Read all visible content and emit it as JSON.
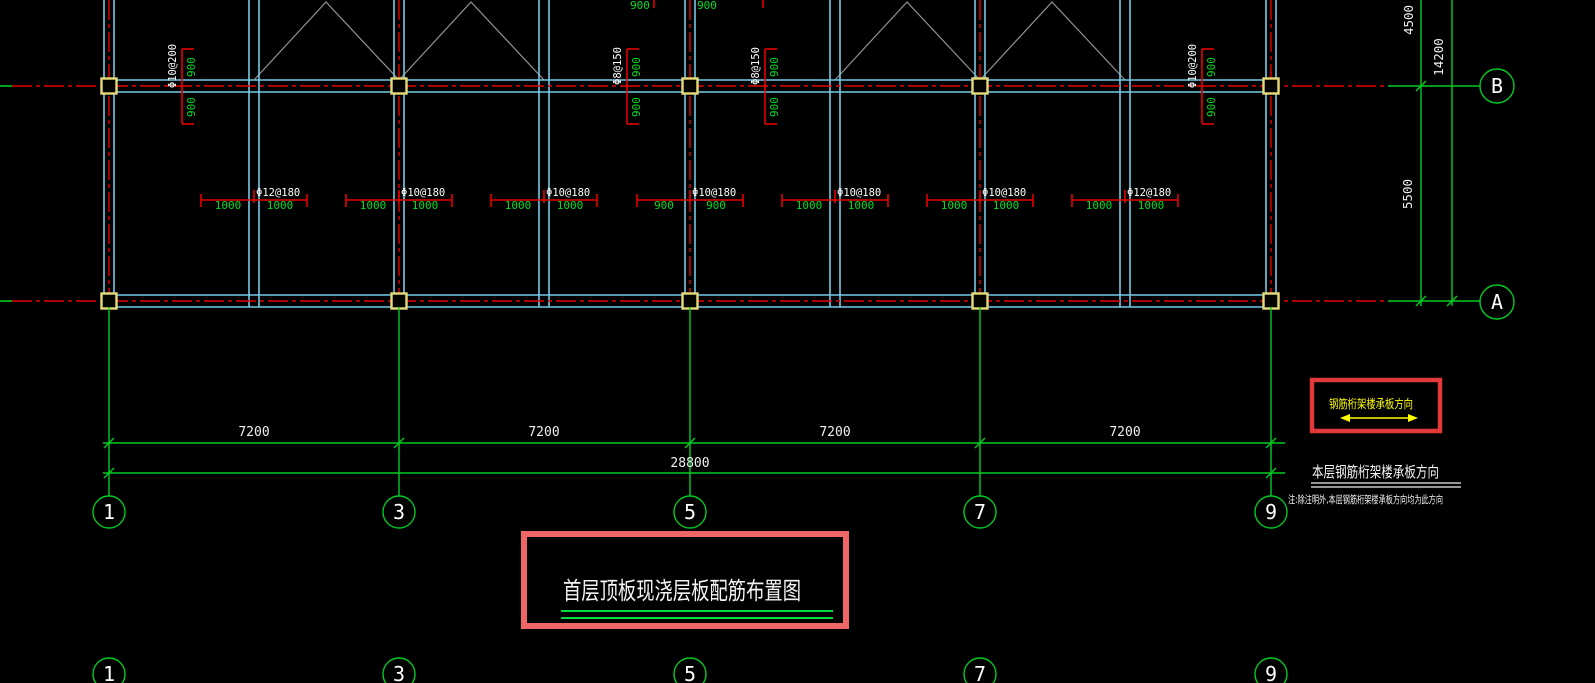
{
  "title_block": {
    "title": "首层顶板现浇层板配筋布置图"
  },
  "direction_annotation": {
    "box_label": "钢筋桁架楼承板方向",
    "heading": "本层钢筋桁架楼承板方向",
    "note": "注:除注明外,本层钢筋桁架楼承板方向均为此方向"
  },
  "grid_bubbles": {
    "bottom": [
      "1",
      "3",
      "5",
      "7",
      "9"
    ],
    "bottom_partial": [
      "1",
      "3",
      "5",
      "7",
      "9"
    ],
    "right": [
      "B",
      "A"
    ]
  },
  "dimensions": {
    "horizontal_bays": [
      "7200",
      "7200",
      "7200",
      "7200"
    ],
    "horizontal_total": "28800",
    "vertical_top": "4500",
    "vertical_span": "5500",
    "vertical_total": "14200"
  },
  "rebar_vertical": [
    {
      "label": "Φ10@200",
      "above": "900",
      "below": "900"
    },
    {
      "label": "Φ8@150",
      "above": "900",
      "below": "900"
    },
    {
      "label": "Φ8@150",
      "above": "900",
      "below": "900"
    },
    {
      "label": "Φ10@200",
      "above": "900",
      "below": "900"
    }
  ],
  "rebar_middle": [
    {
      "label": "Φ12@180",
      "left": "1000",
      "right": "1000"
    },
    {
      "label": "Φ10@180",
      "left": "1000",
      "right": "1000"
    },
    {
      "label": "Φ10@180",
      "left": "1000",
      "right": "1000"
    },
    {
      "label": "Φ10@180",
      "left": "900",
      "right": "900"
    },
    {
      "label": "Φ10@180",
      "left": "1000",
      "right": "1000"
    },
    {
      "label": "Φ10@180",
      "left": "1000",
      "right": "1000"
    },
    {
      "label": "Φ12@180",
      "left": "1000",
      "right": "1000"
    }
  ],
  "rebar_top_edge": {
    "left": "900",
    "right": "900"
  },
  "colors": {
    "background": "#000000",
    "beam": "#76cbe8",
    "grid_line": "#e60000",
    "dimension": "#00cc22",
    "column": "#e8dc78",
    "bracing": "#949494",
    "text_white": "#f0f0f0",
    "highlight_box": "#ef6666",
    "direction_text": "#ffff00"
  }
}
